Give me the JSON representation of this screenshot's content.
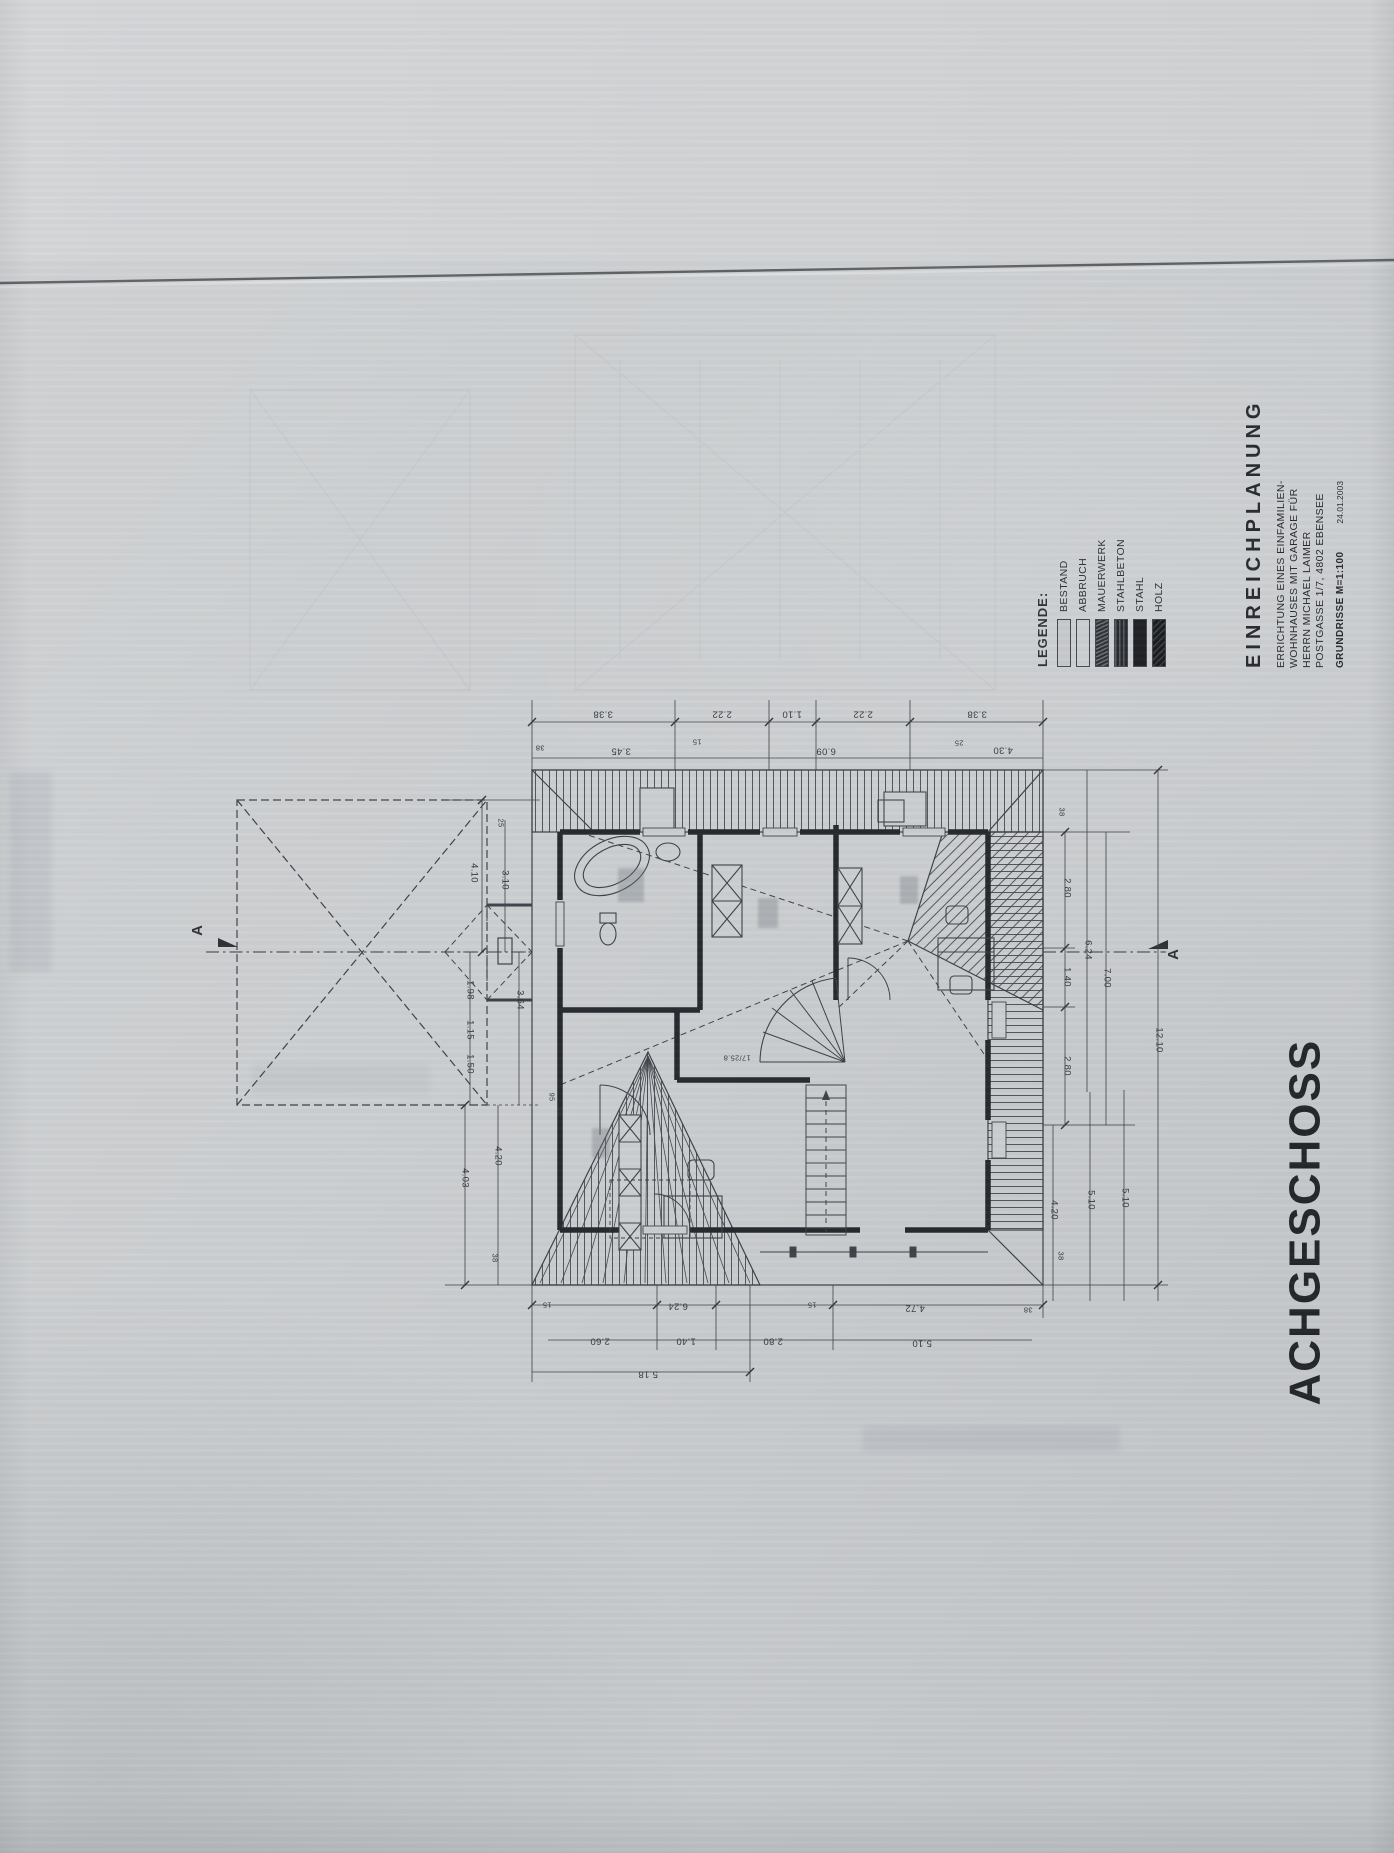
{
  "document": {
    "sheet_title": "ACHGESCHOSS"
  },
  "legend": {
    "heading": "LEGENDE:",
    "items": [
      {
        "label": "BESTAND",
        "style": "light"
      },
      {
        "label": "ABBRUCH",
        "style": "light-dashed"
      },
      {
        "label": "MAUERWERK",
        "style": "hatch-dark"
      },
      {
        "label": "STAHLBETON",
        "style": "hatch-dark2"
      },
      {
        "label": "STAHL",
        "style": "solid-black"
      },
      {
        "label": "HOLZ",
        "style": "solid-dark"
      }
    ]
  },
  "title_block": {
    "heading": "EINREICHPLANUNG",
    "lines": [
      "ERRICHTUNG EINES EINFAMILIEN-",
      "WOHNHAUSES MIT GARAGE FÜR",
      "HERRN MICHAEL LAIMER",
      "POSTGASSE 1/7, 4802 EBENSEE"
    ],
    "scale_line": "GRUNDRISSE  M=1:100",
    "date": "24.01.2003"
  },
  "plan": {
    "section_label": "A",
    "stair_note": "17/25.8",
    "ink_color": "#3c4046",
    "wall_color": "#24272b",
    "dimensions": [
      {
        "t": "3.38",
        "x": 603,
        "y": 714,
        "r": 180
      },
      {
        "t": "2.22",
        "x": 722,
        "y": 714,
        "r": 180
      },
      {
        "t": "1.10",
        "x": 792,
        "y": 714,
        "r": 180
      },
      {
        "t": "2.22",
        "x": 863,
        "y": 714,
        "r": 180
      },
      {
        "t": "3.38",
        "x": 977,
        "y": 714,
        "r": 180
      },
      {
        "t": "38",
        "x": 540,
        "y": 748,
        "r": 180,
        "s": 1
      },
      {
        "t": "3.45",
        "x": 621,
        "y": 751,
        "r": 180
      },
      {
        "t": "15",
        "x": 697,
        "y": 742,
        "r": 180,
        "s": 1
      },
      {
        "t": "6.09",
        "x": 826,
        "y": 751,
        "r": 180
      },
      {
        "t": "25",
        "x": 959,
        "y": 743,
        "r": 180,
        "s": 1
      },
      {
        "t": "4.30",
        "x": 1003,
        "y": 750,
        "r": 180
      },
      {
        "t": "38",
        "x": 1062,
        "y": 812,
        "r": 90,
        "s": 1
      },
      {
        "t": "2.80",
        "x": 1067,
        "y": 888,
        "r": 90
      },
      {
        "t": "1.40",
        "x": 1067,
        "y": 977,
        "r": 90
      },
      {
        "t": "2.80",
        "x": 1067,
        "y": 1066,
        "r": 90
      },
      {
        "t": "6.24",
        "x": 1088,
        "y": 950,
        "r": 90
      },
      {
        "t": "7.00",
        "x": 1107,
        "y": 978,
        "r": 90
      },
      {
        "t": "12.10",
        "x": 1159,
        "y": 1040,
        "r": 90
      },
      {
        "t": "4.20",
        "x": 1054,
        "y": 1210,
        "r": 90
      },
      {
        "t": "38",
        "x": 1061,
        "y": 1256,
        "r": 90,
        "s": 1
      },
      {
        "t": "5.10",
        "x": 1091,
        "y": 1200,
        "r": 90
      },
      {
        "t": "5.10",
        "x": 1125,
        "y": 1198,
        "r": 90
      },
      {
        "t": "4.10",
        "x": 474,
        "y": 873,
        "r": 90
      },
      {
        "t": "25",
        "x": 501,
        "y": 823,
        "r": 90,
        "s": 1
      },
      {
        "t": "3.10",
        "x": 505,
        "y": 880,
        "r": 90
      },
      {
        "t": "1.98",
        "x": 470,
        "y": 990,
        "r": 90
      },
      {
        "t": "1.15",
        "x": 470,
        "y": 1030,
        "r": 90
      },
      {
        "t": "1.50",
        "x": 470,
        "y": 1064,
        "r": 90
      },
      {
        "t": "3.64",
        "x": 520,
        "y": 1000,
        "r": 90
      },
      {
        "t": "4.03",
        "x": 465,
        "y": 1178,
        "r": 90
      },
      {
        "t": "4.20",
        "x": 498,
        "y": 1156,
        "r": 90
      },
      {
        "t": "38",
        "x": 495,
        "y": 1258,
        "r": 90,
        "s": 1
      },
      {
        "t": "95",
        "x": 552,
        "y": 1097,
        "r": 90,
        "s": 1
      },
      {
        "t": "96",
        "x": 560,
        "y": 1112,
        "r": 90,
        "s": 1
      },
      {
        "t": "15",
        "x": 547,
        "y": 1305,
        "r": 180,
        "s": 1
      },
      {
        "t": "6.24",
        "x": 678,
        "y": 1306,
        "r": 180
      },
      {
        "t": "15",
        "x": 812,
        "y": 1305,
        "r": 180,
        "s": 1
      },
      {
        "t": "4.72",
        "x": 915,
        "y": 1308,
        "r": 180
      },
      {
        "t": "38",
        "x": 1028,
        "y": 1310,
        "r": 180,
        "s": 1
      },
      {
        "t": "2.60",
        "x": 600,
        "y": 1341,
        "r": 180
      },
      {
        "t": "1.40",
        "x": 686,
        "y": 1341,
        "r": 180
      },
      {
        "t": "2.80",
        "x": 773,
        "y": 1341,
        "r": 180
      },
      {
        "t": "5.10",
        "x": 922,
        "y": 1343,
        "r": 180
      },
      {
        "t": "5.18",
        "x": 648,
        "y": 1374,
        "r": 180
      },
      {
        "t": "17/25.8",
        "x": 737,
        "y": 1058,
        "r": 180,
        "s": 1
      }
    ]
  }
}
